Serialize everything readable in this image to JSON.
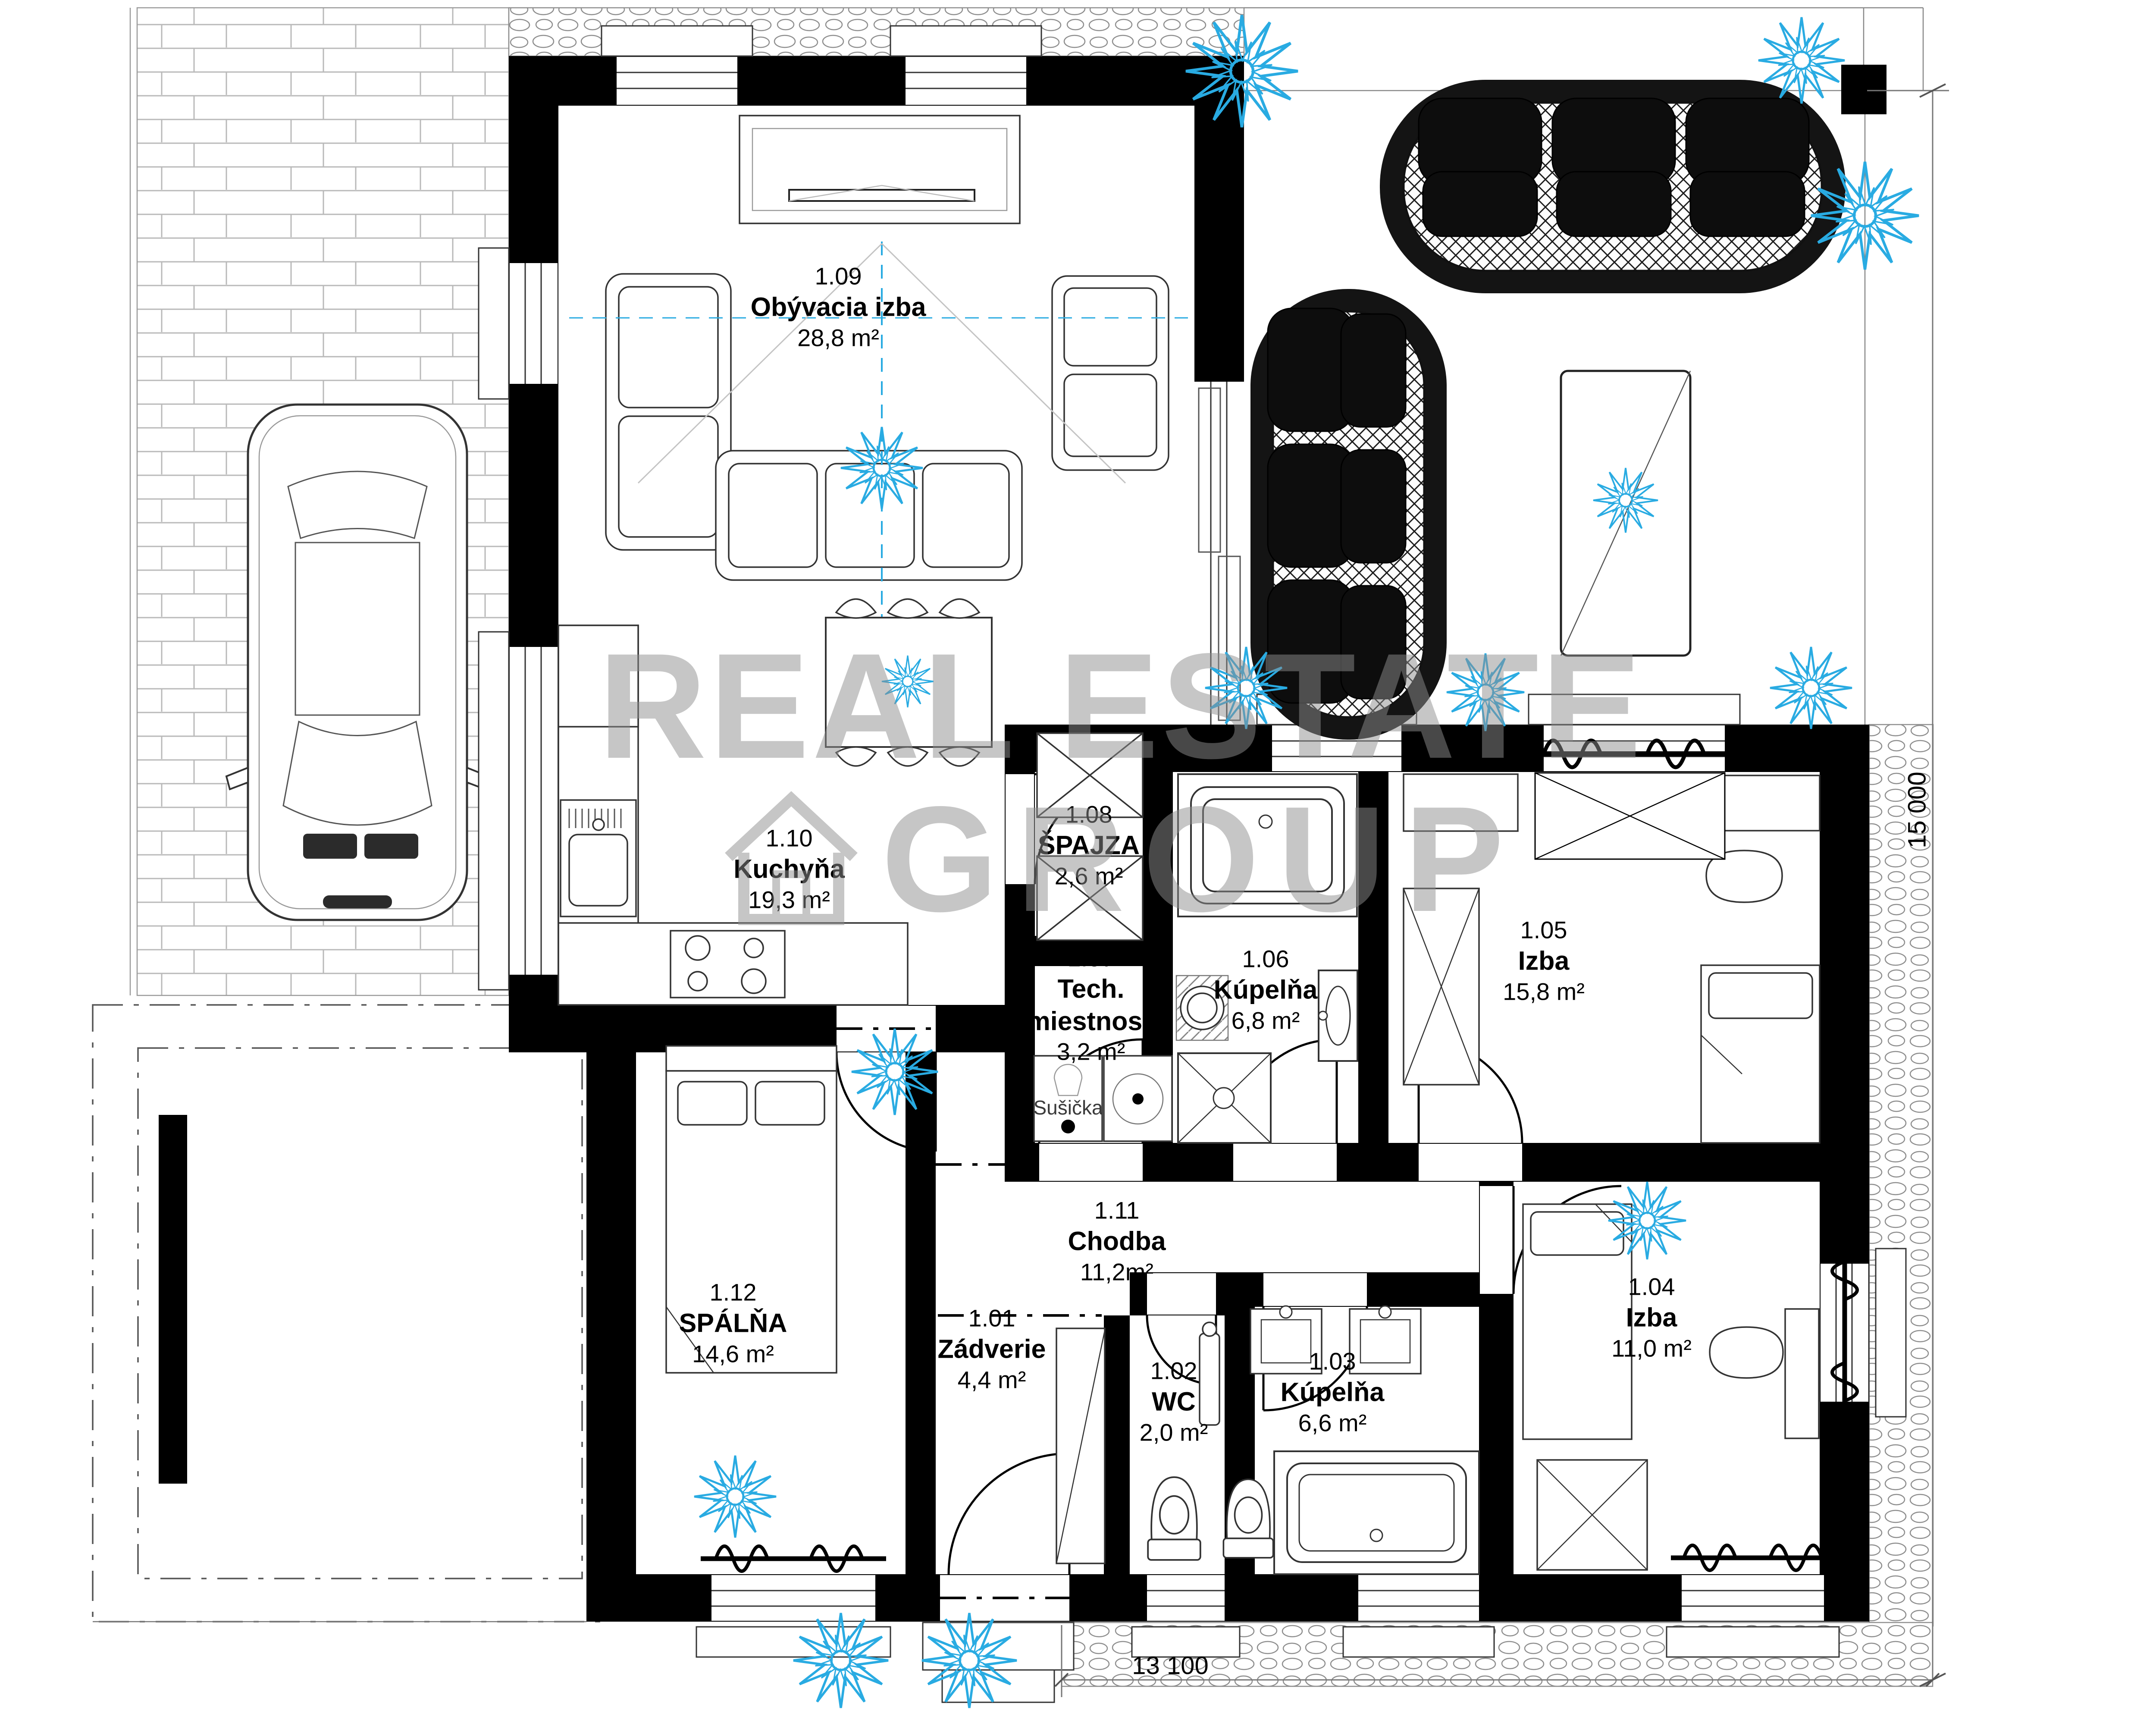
{
  "watermark": {
    "line1": "REAL ESTATE",
    "line2": "GROUP"
  },
  "rooms": [
    {
      "number": "1.09",
      "name": "Obývacia izba",
      "name2": "",
      "area": "28,8 m²"
    },
    {
      "number": "1.10",
      "name": "Kuchyňa",
      "name2": "",
      "area": "19,3 m²"
    },
    {
      "number": "1.08",
      "name": "ŠPAJZA",
      "name2": "",
      "area": "2,6 m²"
    },
    {
      "number": "1.07",
      "name": "Tech.",
      "name2": "miestnosť",
      "area": "3,2 m²"
    },
    {
      "number": "1.06",
      "name": "Kúpelňa",
      "name2": "",
      "area": "6,8 m²"
    },
    {
      "number": "1.05",
      "name": "Izba",
      "name2": "",
      "area": "15,8 m²"
    },
    {
      "number": "1.11",
      "name": "Chodba",
      "name2": "",
      "area": "11,2m²"
    },
    {
      "number": "1.12",
      "name": "SPÁLŇA",
      "name2": "",
      "area": "14,6 m²"
    },
    {
      "number": "1.01",
      "name": "Zádverie",
      "name2": "",
      "area": "4,4 m²"
    },
    {
      "number": "1.02",
      "name": "WC",
      "name2": "",
      "area": "2,0 m²"
    },
    {
      "number": "1.03",
      "name": "Kúpelňa",
      "name2": "",
      "area": "6,6 m²"
    },
    {
      "number": "1.04",
      "name": "Izba",
      "name2": "",
      "area": "11,0 m²"
    }
  ],
  "appliance_labels": {
    "dryer": "Sušička"
  },
  "dimensions": {
    "height_mm": "15 000",
    "width_mm": "13 100"
  },
  "colors": {
    "accent_cyan": "#29abe2",
    "wall": "#000000",
    "watermark_gray": "#8f8f8f"
  }
}
